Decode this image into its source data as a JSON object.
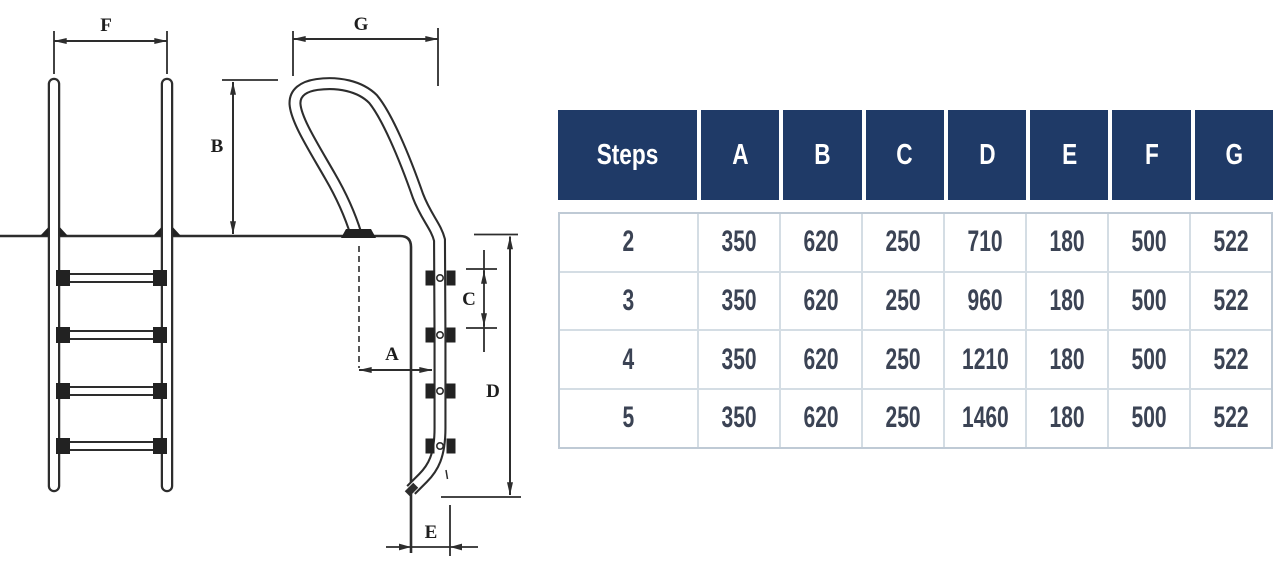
{
  "diagram": {
    "labels": {
      "F": "F",
      "B": "B",
      "G": "G",
      "A": "A",
      "C": "C",
      "D": "D",
      "E": "E"
    }
  },
  "table": {
    "header": [
      "Steps",
      "A",
      "B",
      "C",
      "D",
      "E",
      "F",
      "G"
    ],
    "rows": [
      [
        "2",
        "350",
        "620",
        "250",
        "710",
        "180",
        "500",
        "522"
      ],
      [
        "3",
        "350",
        "620",
        "250",
        "960",
        "180",
        "500",
        "522"
      ],
      [
        "4",
        "350",
        "620",
        "250",
        "1210",
        "180",
        "500",
        "522"
      ],
      [
        "5",
        "350",
        "620",
        "250",
        "1460",
        "180",
        "500",
        "522"
      ]
    ],
    "colors": {
      "header_bg": "#1f3a67",
      "header_text": "#ffffff",
      "body_text": "#3b4354",
      "grid_line": "#d4dde4"
    }
  }
}
